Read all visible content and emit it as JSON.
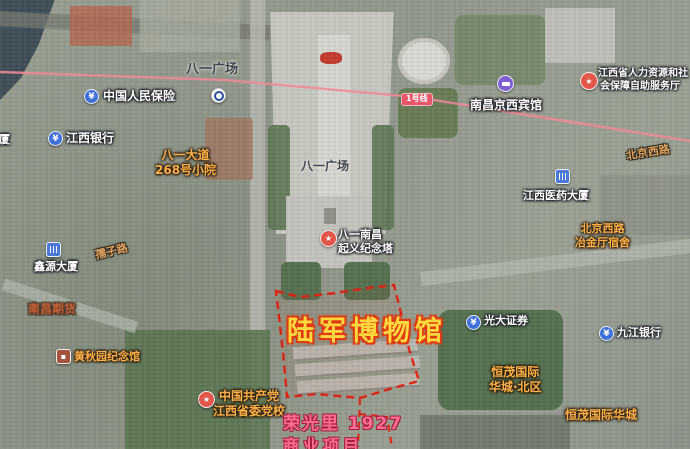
{
  "map_type": "satellite",
  "metro": {
    "line_badge": "1号线"
  },
  "pois": {
    "picc": "中国人民保险",
    "jiangxi_bank": "江西银行",
    "partial_daxia": "大厦",
    "bayi_square_station": "八一广场",
    "bayi_268_l1": "八一大道",
    "bayi_268_l2": "268号小院",
    "jingxi_hotel": "南昌京西宾馆",
    "hr_l1": "江西省人力资源和社",
    "hr_l2": "会保障自助服务厅",
    "medical_building": "江西医药大厦",
    "dorm_l1": "北京西路",
    "dorm_l2": "冶金厅宿舍",
    "bayi_square_center": "八一广场",
    "tower_l1": "八一南昌",
    "tower_l2": "起义纪念塔",
    "xinyuan": "鑫源大厦",
    "qihuo": "南昌期货",
    "huang": "黄秋园纪念馆",
    "party_l1": "中国共产党",
    "party_l2": "江西省委党校",
    "everbright": "光大证券",
    "jiujiang_bank": "九江银行",
    "hengmao_north_l1": "恒茂国际",
    "hengmao_north_l2": "华城·北区",
    "hengmao": "恒茂国际华城"
  },
  "roads": {
    "beijing_west": "北京西路",
    "ruzi": "孺子路"
  },
  "annotations": {
    "army_museum": "陆军博物馆",
    "rong_l1": "荣光里 1927",
    "rong_l2": "商业项目"
  },
  "icons": {
    "yuan": "¥",
    "star": "★"
  },
  "colors": {
    "boundary_red": "#e01e10",
    "museum_text": "#ffd83d",
    "museum_outline": "#e03c12",
    "pink_label": "#ff6d93",
    "orange_label": "#ffb14a",
    "metro_line": "#f0889a",
    "badge_red": "#e8546a"
  }
}
